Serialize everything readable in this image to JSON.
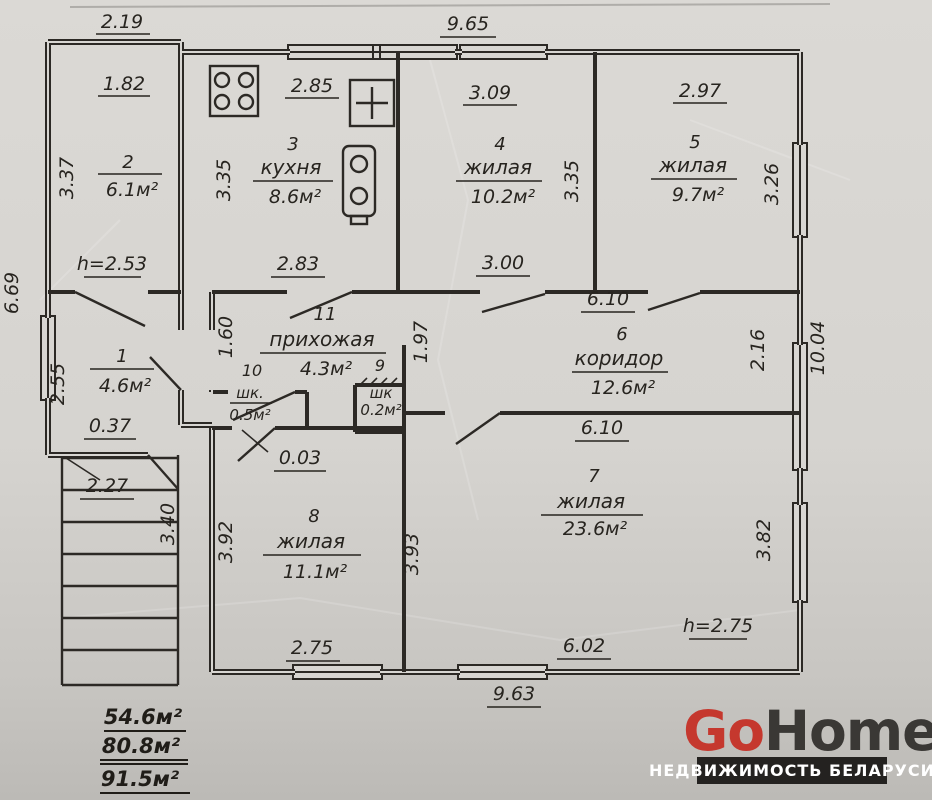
{
  "rooms": [
    {
      "id": "room-2",
      "number": "2",
      "name": "",
      "area": "6.1м²"
    },
    {
      "id": "room-3",
      "number": "3",
      "name": "кухня",
      "area": "8.6м²"
    },
    {
      "id": "room-4",
      "number": "4",
      "name": "жилая",
      "area": "10.2м²"
    },
    {
      "id": "room-5",
      "number": "5",
      "name": "жилая",
      "area": "9.7м²"
    },
    {
      "id": "room-11",
      "number": "11",
      "name": "прихожая",
      "area": "4.3м²"
    },
    {
      "id": "room-6",
      "number": "6",
      "name": "коридор",
      "area": "12.6м²"
    },
    {
      "id": "room-1",
      "number": "1",
      "name": "",
      "area": "4.6м²"
    },
    {
      "id": "room-10",
      "number": "10",
      "name": "шк.",
      "area": "0.5м²"
    },
    {
      "id": "room-9",
      "number": "9",
      "name": "шк",
      "area": "0.2м²"
    },
    {
      "id": "room-8",
      "number": "8",
      "name": "жилая",
      "area": "11.1м²"
    },
    {
      "id": "room-7",
      "number": "7",
      "name": "жилая",
      "area": "23.6м²"
    }
  ],
  "dims": {
    "annex_width": "2.19",
    "main_width_top": "9.65",
    "room2_w": "1.82",
    "room2_h": "3.37",
    "kitchen_w": "2.85",
    "kitchen_h": "3.35",
    "room4_w": "3.09",
    "room4_h": "3.35",
    "room5_w": "2.97",
    "room5_h": "3.26",
    "left_height": "6.69",
    "hall_top": "2.83",
    "mid_top": "3.00",
    "corridor_top": "6.10",
    "corridor_bottom": "6.10",
    "hall_h": "1.60",
    "corridor_h": "1.97",
    "niche_h": "2.16",
    "right_height": "10.04",
    "room1_h": "2.55",
    "notch": "0.37",
    "porch_w": "2.27",
    "porch_h": "3.40",
    "gap": "0.03",
    "room8_h": "3.92",
    "center_h": "3.93",
    "room7_h": "3.82",
    "room8_w": "2.75",
    "room7_w": "6.02",
    "bottom_width": "9.63"
  },
  "heights": {
    "ceiling_left": "h=2.53",
    "ceiling_right": "h=2.75"
  },
  "totals": {
    "top": "54.6м²",
    "middle": "80.8м²",
    "bottom": "91.5м²"
  },
  "logo": {
    "brand_go": "Go",
    "brand_home": "Home",
    "tagline": "НЕДВИЖИМОСТЬ БЕЛАРУСИ"
  },
  "colors": {
    "brand_red": "#c5382e",
    "logo_dark": "#242220",
    "ink": "#2c2925",
    "paper": "#d8d6d2"
  }
}
